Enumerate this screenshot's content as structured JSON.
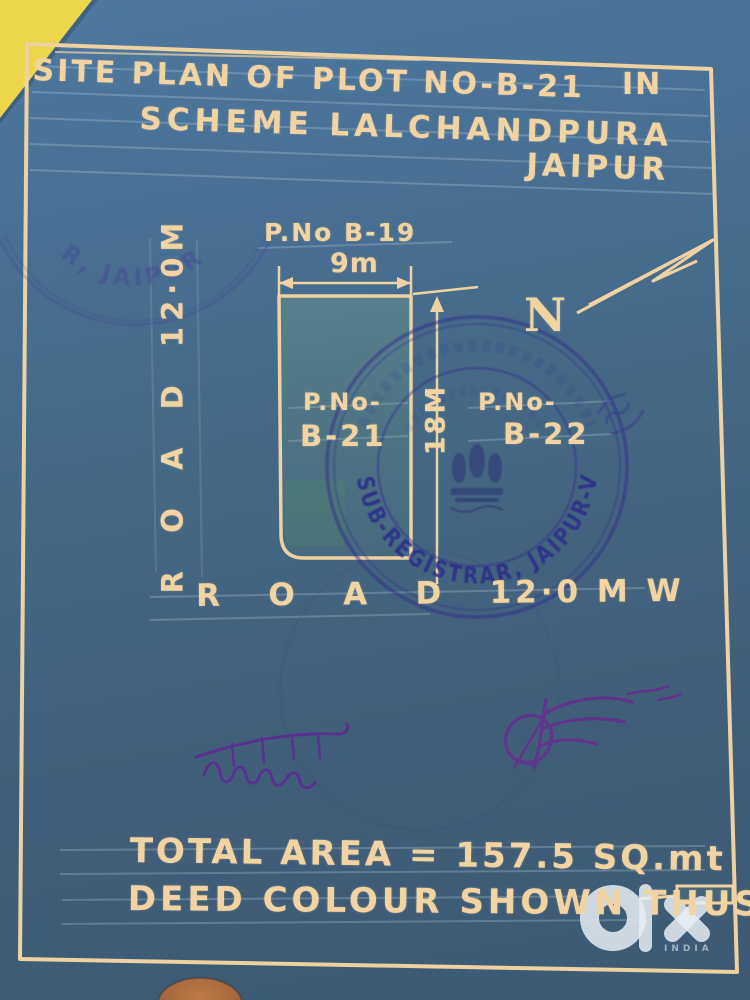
{
  "document": {
    "title_line1": "SITE PLAN OF PLOT NO-B-21",
    "title_line1_suffix": "IN",
    "title_line2": "SCHEME LALCHANDPURA",
    "title_line3": "JAIPUR",
    "total_area_line": "TOTAL AREA = 157.5 SQ.mt",
    "deed_colour_line": "DEED COLOUR SHOWN THUS"
  },
  "plan": {
    "north_label": "N",
    "adjacent_plot_top": "P.No B-19",
    "width_dimension": "9m",
    "height_dimension": "18M",
    "plot_label_line1": "P.No-",
    "plot_label_line2": "B-21",
    "adjacent_plot_right_line1": "P.No-",
    "adjacent_plot_right_line2": "B-22",
    "road_left_label": "R  O  A  D  12·0M",
    "road_bottom_label": "R   O   A   D   12·0 M W",
    "plot_width_m": 9,
    "plot_height_m": 18,
    "road_width_m": 12.0,
    "total_area_sqm": 157.5
  },
  "stamps": {
    "main_round_stamp": {
      "text": "SUB-REGISTRAR, JAIPUR-V",
      "hindi_side_text": "(राज)",
      "emblem": "ashoka-lion-capital",
      "emblem_motto": "सत्यमेव जयते",
      "ink_color": "#2c2a8a"
    },
    "faint_top_left_stamp": {
      "visible_text": "R, JAIPUR",
      "ink_color": "#403e96"
    }
  },
  "signatures": {
    "left": {
      "style": "devanagari-handwriting",
      "ink_color": "#5b2d92"
    },
    "right": {
      "style": "cursive-flourish",
      "ink_color": "#64308e"
    }
  },
  "watermark": {
    "logo": "olx",
    "country_label": "INDIA"
  },
  "colors": {
    "paper_blue": "#48708f",
    "drawing_cream": "#f2d4a2",
    "corner_yellow": "#ecd74b",
    "deed_colour_tint": "#6fa57a",
    "stamp_ink": "#2c2a8a",
    "signature_ink": "#5b2d92",
    "finger_skin": "#a5653c"
  }
}
